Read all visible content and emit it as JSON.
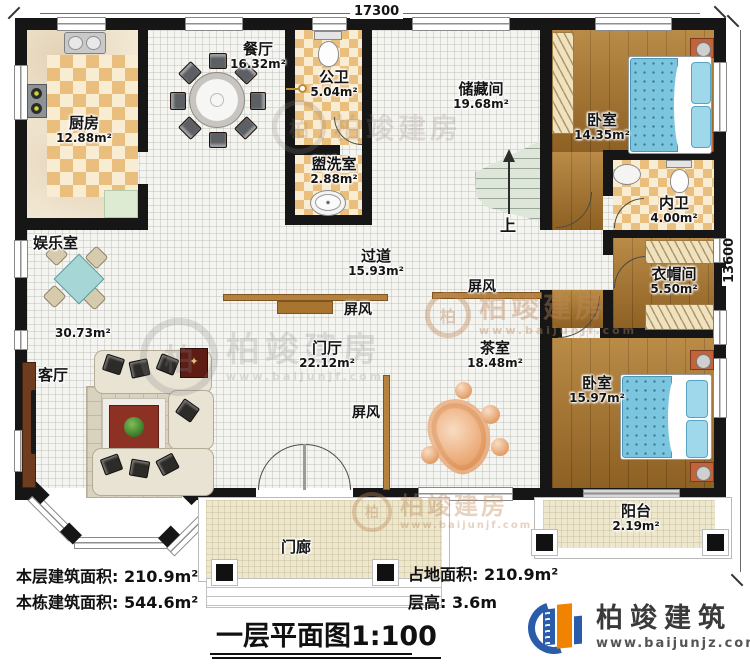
{
  "dims": {
    "top": "17300",
    "right": "13600"
  },
  "rooms": {
    "kitchen": {
      "name": "厨房",
      "area": "12.88m²"
    },
    "dining": {
      "name": "餐厅",
      "area": "16.32m²"
    },
    "public_bath": {
      "name": "公卫",
      "area": "5.04m²"
    },
    "washroom": {
      "name": "盥洗室",
      "area": "2.88m²"
    },
    "storage": {
      "name": "储藏间",
      "area": "19.68m²"
    },
    "bedroom_top": {
      "name": "卧室",
      "area": "14.35m²"
    },
    "inner_bath": {
      "name": "内卫",
      "area": "4.00m²"
    },
    "cloakroom": {
      "name": "衣帽间",
      "area": "5.50m²"
    },
    "bedroom_bottom": {
      "name": "卧室",
      "area": "15.97m²"
    },
    "balcony": {
      "name": "阳台",
      "area": "2.19m²"
    },
    "entertainment": {
      "name": "娱乐室",
      "area": "30.73m²"
    },
    "living": {
      "name": "客厅"
    },
    "corridor": {
      "name": "过道",
      "area": "15.93m²"
    },
    "foyer": {
      "name": "门厅",
      "area": "22.12m²"
    },
    "tea_room": {
      "name": "茶室",
      "area": "18.48m²"
    },
    "porch": {
      "name": "门廊"
    },
    "screen": {
      "name": "屏风"
    },
    "stairs": {
      "up": "上"
    }
  },
  "footer": {
    "line1": "本层建筑面积: 210.9m²",
    "line2": "本栋建筑面积: 544.6m²",
    "line3": "占地面积: 210.9m²",
    "line4": "层高: 3.6m",
    "title": "一层平面图1:100"
  },
  "logo": {
    "brand": "柏竣建筑",
    "url": "www.baijunjz.com"
  },
  "watermark": {
    "badge": "柏",
    "brand": "柏竣建房",
    "url": "www.baijunjf.com"
  }
}
